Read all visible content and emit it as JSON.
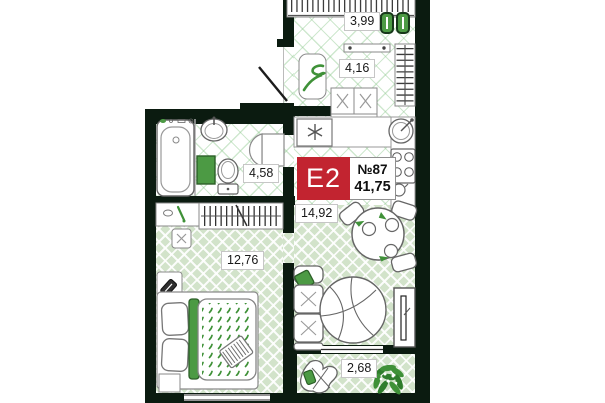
{
  "unit_badge": {
    "type_label": "E2",
    "number": "№87",
    "total_area": "41,75"
  },
  "rooms": [
    {
      "name": "wardrobe",
      "area_label": "3,99"
    },
    {
      "name": "hallway",
      "area_label": "4,16"
    },
    {
      "name": "bathroom",
      "area_label": "4,58"
    },
    {
      "name": "kitchen_living_room",
      "area_label": "14,92"
    },
    {
      "name": "bedroom",
      "area_label": "12,76"
    },
    {
      "name": "balcony",
      "area_label": "2,68"
    }
  ],
  "colors": {
    "wall": "#0b1b10",
    "badge_red": "#c22430",
    "accent_green": "#4c9a44",
    "floor_wood": "#d2e3ca",
    "floor_tile_line": "#cfe7cf"
  },
  "furniture_icons": {
    "wardrobe": [
      "clothes-rail-icon",
      "green-accessory-icon"
    ],
    "hallway": [
      "console-shelf-icon",
      "bench-icon",
      "hanger-rail-icon",
      "storage-box-icon"
    ],
    "kitchen": [
      "washing-machine-icon",
      "kitchen-sink-icon",
      "stove-icon",
      "kettle-icon"
    ],
    "bathroom": [
      "bathtub-icon",
      "washbasin-icon",
      "toilet-icon",
      "bath-mat-icon",
      "door-icon"
    ],
    "bedroom": [
      "dresser-icon",
      "hanger-rail-icon",
      "pouf-icon",
      "phone-stand-icon",
      "bed-icon",
      "laptop-icon",
      "nightstand-icon"
    ],
    "living_room": [
      "dining-table-icon",
      "chair-icon",
      "plate-icon",
      "sofa-icon",
      "lounge-chair-icon",
      "tv-console-icon"
    ],
    "balcony": [
      "lounge-chair-icon",
      "plant-icon"
    ]
  }
}
